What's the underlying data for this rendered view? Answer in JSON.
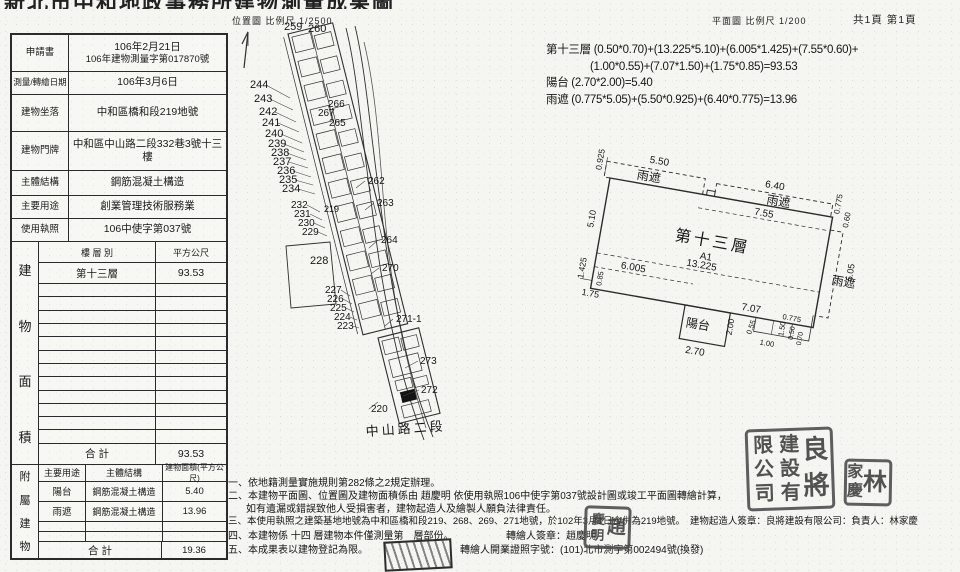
{
  "header": {
    "title": "新北市中和地政事務所建物測量成果圖",
    "map_scale": "位置圖 比例尺  1/2500",
    "plan_scale": "平面圖 比例尺  1/200",
    "page": "共1頁 第1頁"
  },
  "info_table": {
    "rows": [
      {
        "label": "申請書",
        "value": "106年2月21日",
        "value2": "106年建物測量字第017870號"
      },
      {
        "label": "測量/轉繪日期",
        "value": "106年3月6日"
      },
      {
        "label": "建物坐落",
        "value": "中和區橋和段219地號"
      },
      {
        "label": "建物門牌",
        "value": "中和區中山路二段332巷3號十三樓"
      },
      {
        "label": "主體結構",
        "value": "鋼筋混凝土構造"
      },
      {
        "label": "主要用途",
        "value": "創業管理技術服務業"
      },
      {
        "label": "使用執照",
        "value": "106中使字第037號"
      }
    ]
  },
  "area_table": {
    "side_label": "建物面積",
    "col1": "樓 層 別",
    "col2": "平方公尺",
    "rows": [
      {
        "floor": "第十三層",
        "area": "93.53"
      }
    ],
    "empty_rows": 12,
    "total_label": "合  計",
    "total": "93.53"
  },
  "annex_table": {
    "side_label": "附屬建物",
    "headers": [
      "主要用途",
      "主體結構",
      "建物面積(平方公尺)"
    ],
    "rows": [
      [
        "陽台",
        "鋼筋混凝土構造",
        "5.40"
      ],
      [
        "雨遮",
        "鋼筋混凝土構造",
        "13.96"
      ]
    ],
    "empty_rows": 2,
    "total_label": "合  計",
    "total": "19.36"
  },
  "formulas": {
    "lines": [
      {
        "t": "第十三層 (0.50*0.70)+(13.225*5.10)+(6.005*1.425)+(7.55*0.60)+",
        "ind": 0
      },
      {
        "t": "(1.00*0.55)+(7.07*1.50)+(1.75*0.85)=93.53",
        "ind": 1
      },
      {
        "t": "陽台 (2.70*2.00)=5.40",
        "ind": 0
      },
      {
        "t": "雨遮 (0.775*5.05)+(5.50*0.925)+(6.40*0.775)=13.96",
        "ind": 0
      }
    ]
  },
  "site_map": {
    "labels": [
      {
        "t": "259",
        "x": 56,
        "y": 22,
        "s": 11
      },
      {
        "t": "260",
        "x": 80,
        "y": 24,
        "s": 11
      },
      {
        "t": "244",
        "x": 22,
        "y": 80,
        "s": 11
      },
      {
        "t": "243",
        "x": 26,
        "y": 94,
        "s": 11
      },
      {
        "t": "242",
        "x": 31,
        "y": 107,
        "s": 11
      },
      {
        "t": "241",
        "x": 34,
        "y": 118,
        "s": 11
      },
      {
        "t": "240",
        "x": 37,
        "y": 129,
        "s": 11
      },
      {
        "t": "239",
        "x": 40,
        "y": 139,
        "s": 11
      },
      {
        "t": "238",
        "x": 43,
        "y": 148,
        "s": 11
      },
      {
        "t": "237",
        "x": 45,
        "y": 157,
        "s": 11
      },
      {
        "t": "236",
        "x": 49,
        "y": 166,
        "s": 11
      },
      {
        "t": "235",
        "x": 51,
        "y": 175,
        "s": 11
      },
      {
        "t": "234",
        "x": 54,
        "y": 184,
        "s": 11
      },
      {
        "t": "266",
        "x": 100,
        "y": 99,
        "s": 10
      },
      {
        "t": "267",
        "x": 90,
        "y": 108,
        "s": 10
      },
      {
        "t": "265",
        "x": 101,
        "y": 118,
        "s": 10
      },
      {
        "t": "262",
        "x": 140,
        "y": 176,
        "s": 10
      },
      {
        "t": "263",
        "x": 149,
        "y": 198,
        "s": 10
      },
      {
        "t": "219",
        "x": 96,
        "y": 204,
        "s": 9
      },
      {
        "t": "232",
        "x": 63,
        "y": 200,
        "s": 10
      },
      {
        "t": "231",
        "x": 66,
        "y": 209,
        "s": 10
      },
      {
        "t": "230",
        "x": 70,
        "y": 218,
        "s": 10
      },
      {
        "t": "229",
        "x": 74,
        "y": 227,
        "s": 10
      },
      {
        "t": "264",
        "x": 153,
        "y": 235,
        "s": 10
      },
      {
        "t": "228",
        "x": 82,
        "y": 256,
        "s": 11
      },
      {
        "t": "270",
        "x": 154,
        "y": 263,
        "s": 10
      },
      {
        "t": "227",
        "x": 97,
        "y": 285,
        "s": 10
      },
      {
        "t": "226",
        "x": 99,
        "y": 294,
        "s": 10
      },
      {
        "t": "225",
        "x": 102,
        "y": 303,
        "s": 10
      },
      {
        "t": "224",
        "x": 106,
        "y": 312,
        "s": 10
      },
      {
        "t": "223",
        "x": 109,
        "y": 321,
        "s": 10
      },
      {
        "t": "271-1",
        "x": 168,
        "y": 314,
        "s": 10
      },
      {
        "t": "273",
        "x": 192,
        "y": 356,
        "s": 10
      },
      {
        "t": "272",
        "x": 193,
        "y": 385,
        "s": 10
      },
      {
        "t": "220",
        "x": 143,
        "y": 404,
        "s": 10
      },
      {
        "t": "A1",
        "x": 166,
        "y": 391,
        "s": 6.5,
        "f": "#ffffff"
      },
      {
        "t": "中山路二段",
        "x": 138,
        "y": 428,
        "s": 13,
        "r": -4,
        "ls": 3
      }
    ],
    "leaders": [
      [
        38,
        77,
        62,
        90
      ],
      [
        42,
        91,
        65,
        102
      ],
      [
        47,
        104,
        68,
        114
      ],
      [
        50,
        115,
        71,
        124
      ],
      [
        53,
        126,
        74,
        135
      ],
      [
        56,
        136,
        76,
        144
      ],
      [
        59,
        145,
        78,
        152
      ],
      [
        61,
        154,
        80,
        160
      ],
      [
        65,
        163,
        83,
        169
      ],
      [
        67,
        172,
        85,
        177
      ],
      [
        70,
        181,
        87,
        186
      ],
      [
        79,
        197,
        92,
        204
      ],
      [
        82,
        206,
        94,
        212
      ],
      [
        86,
        215,
        97,
        220
      ],
      [
        90,
        224,
        99,
        228
      ],
      [
        113,
        282,
        122,
        288
      ],
      [
        115,
        291,
        124,
        296
      ],
      [
        118,
        300,
        126,
        304
      ],
      [
        122,
        309,
        129,
        312
      ],
      [
        125,
        318,
        131,
        320
      ],
      [
        137,
        173,
        128,
        180
      ],
      [
        146,
        195,
        137,
        202
      ],
      [
        150,
        232,
        141,
        240
      ],
      [
        151,
        260,
        143,
        266
      ],
      [
        165,
        311,
        157,
        318
      ],
      [
        190,
        353,
        177,
        360
      ],
      [
        191,
        382,
        175,
        388
      ],
      [
        141,
        401,
        150,
        394
      ]
    ]
  },
  "floor_plan": {
    "labels": [
      {
        "t": "0.925",
        "x": -10,
        "y": -6,
        "r": -90,
        "s": 8.5
      },
      {
        "t": "5.50",
        "x": 36,
        "y": -22,
        "s": 10
      },
      {
        "t": "雨遮",
        "x": 26,
        "y": -4,
        "s": 12
      },
      {
        "t": "6.40",
        "x": 154,
        "y": -18,
        "s": 10
      },
      {
        "t": "雨遮",
        "x": 158,
        "y": -2,
        "s": 12
      },
      {
        "t": "7.55",
        "x": 148,
        "y": 11,
        "s": 10
      },
      {
        "t": "0.775",
        "x": 232,
        "y": -4,
        "r": -90,
        "s": 8
      },
      {
        "t": "0.60",
        "x": 243,
        "y": 8,
        "r": -90,
        "s": 8
      },
      {
        "t": "5.10",
        "x": -8,
        "y": 52,
        "r": -90,
        "s": 9
      },
      {
        "t": "1.425",
        "x": -9,
        "y": 104,
        "r": -90,
        "s": 8.5
      },
      {
        "t": "第十三層",
        "x": 74,
        "y": 50,
        "s": 16,
        "ls": 3
      },
      {
        "t": "A1",
        "x": 102,
        "y": 64,
        "s": 10
      },
      {
        "t": "13.225",
        "x": 90,
        "y": 73,
        "s": 10
      },
      {
        "t": "6.005",
        "x": 26,
        "y": 87,
        "s": 10
      },
      {
        "t": "0.85",
        "x": 10,
        "y": 108,
        "r": -90,
        "s": 7.5
      },
      {
        "t": "1.75",
        "x": -8,
        "y": 120,
        "s": 9
      },
      {
        "t": "7.07",
        "x": 152,
        "y": 107,
        "s": 10
      },
      {
        "t": "陽台",
        "x": 100,
        "y": 133,
        "s": 12
      },
      {
        "t": "2.00",
        "x": 147,
        "y": 134,
        "r": -90,
        "s": 8.5
      },
      {
        "t": "2.70",
        "x": 104,
        "y": 159,
        "s": 10
      },
      {
        "t": "0.55",
        "x": 166,
        "y": 130,
        "r": -80,
        "s": 7.5
      },
      {
        "t": "1.00",
        "x": 176,
        "y": 138,
        "s": 7.5
      },
      {
        "t": "1.50",
        "x": 198,
        "y": 126,
        "r": -90,
        "s": 7.5
      },
      {
        "t": "0.50",
        "x": 208,
        "y": 128,
        "r": -90,
        "s": 7
      },
      {
        "t": "0.70",
        "x": 217,
        "y": 132,
        "r": -90,
        "s": 7
      },
      {
        "t": "0.775",
        "x": 194,
        "y": 109,
        "s": 7.5
      },
      {
        "t": "雨遮",
        "x": 236,
        "y": 66,
        "s": 12
      },
      {
        "t": "5.05",
        "x": 256,
        "y": 60,
        "r": -90,
        "s": 9
      }
    ]
  },
  "notes": [
    {
      "t": "一、依地籍測量實施規則第282條之2規定辦理。",
      "x": 228,
      "y": 474
    },
    {
      "t": "二、本建物平面圖、位置圖及建物面積係由 趙慶明 依使用執照106中使字第037號設計圖或竣工平面圖轉繪計算，",
      "x": 228,
      "y": 487
    },
    {
      "t": "如有遺漏或錯誤致他人受損害者，建物起造人及繪製人願負法律責任。",
      "x": 246,
      "y": 500
    },
    {
      "t": "三、本使用執照之建築基地地號為中和區橋和段219、268、269、271地號，於102年3月1日合併為219地號。　建物起造人簽章：良將建設有限公司：負責人：林家慶",
      "x": 228,
      "y": 513,
      "fs": 9.5
    },
    {
      "t": "四、本建物係 十四 層建物本件僅測量第　層部份。",
      "x": 228,
      "y": 527
    },
    {
      "t": "轉繪人簽章：趙慶明",
      "x": 506,
      "y": 527
    },
    {
      "t": "五、本成果表以建物登記為限。",
      "x": 228,
      "y": 541
    },
    {
      "t": "轉繪人開業證照字號：(101)北市測字第002494號(換發)",
      "x": 460,
      "y": 541
    }
  ],
  "stamps": {
    "seals": [
      {
        "name": "company-seal",
        "cols": [
          [
            "良",
            "將"
          ],
          [
            "建",
            "設",
            "有"
          ],
          [
            "限",
            "公",
            "司"
          ]
        ],
        "x": 746,
        "y": 428,
        "w": 88,
        "h": 82,
        "fs": [
          26,
          20,
          20
        ],
        "rot": -2
      },
      {
        "name": "person-seal",
        "cols": [
          [
            "林"
          ],
          [
            "家",
            "慶"
          ]
        ],
        "x": 844,
        "y": 459,
        "w": 48,
        "h": 47,
        "fs": [
          24,
          16
        ],
        "rot": 1
      },
      {
        "name": "drafter-seal",
        "cols": [
          [
            "趙"
          ],
          [
            "慶",
            "明"
          ]
        ],
        "x": 584,
        "y": 506,
        "w": 47,
        "h": 43,
        "fs": [
          19,
          13
        ],
        "rot": 2
      }
    ]
  }
}
